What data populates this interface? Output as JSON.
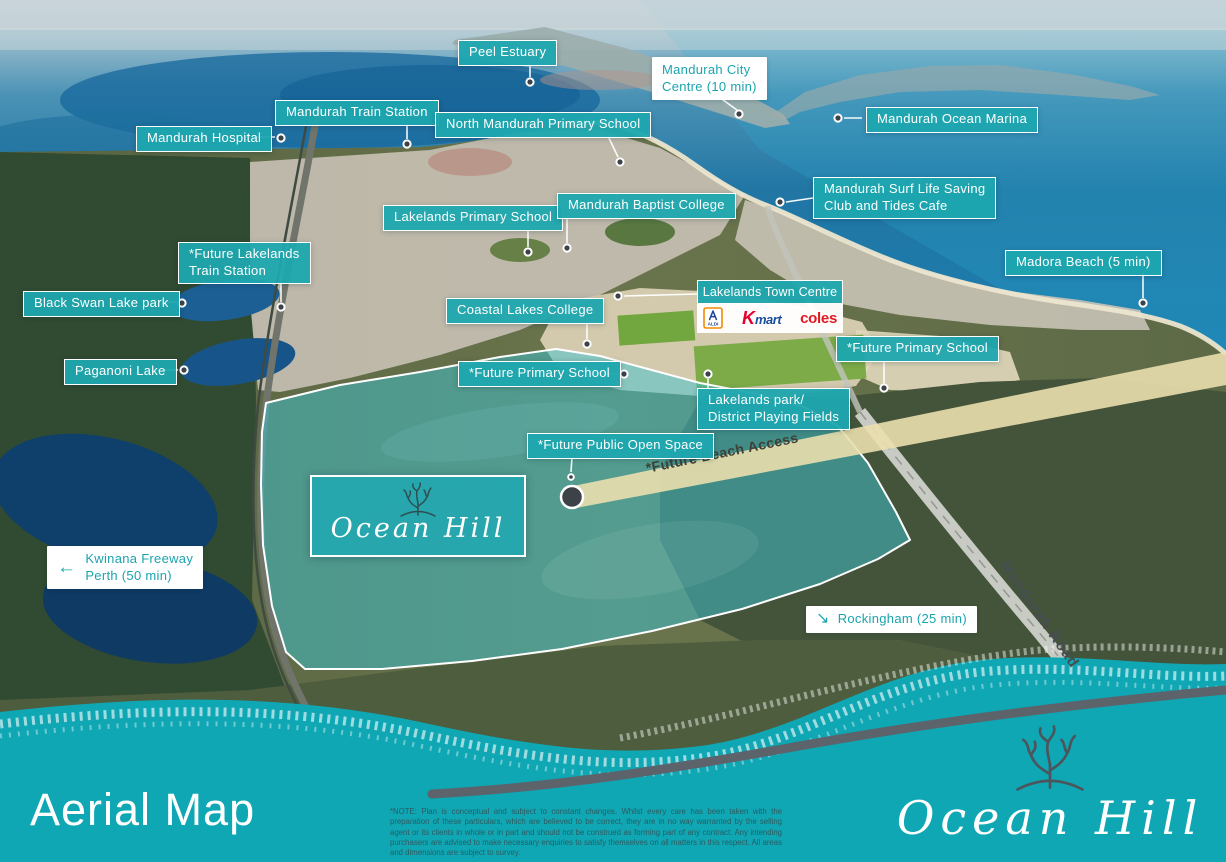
{
  "brand": {
    "script_text": "Ocean Hill"
  },
  "colors": {
    "label_teal": "#1ea6af",
    "accent_teal": "#1ba4ae",
    "band_teal": "#0fa7b4",
    "wave_gray": "#5c636b",
    "beach_band": "#eadfae",
    "dot_dark": "#3d4249",
    "kmart_red": "#e4002b",
    "kmart_blue": "#1c4f9e",
    "coles_red": "#e01a22",
    "aldi_blue": "#1b4297",
    "aldi_orange": "#f28b00"
  },
  "icons": {
    "arrow_left": "←",
    "arrow_southeast": "↘"
  },
  "map_labels": [
    {
      "id": "peel-estuary",
      "text": "Peel Estuary"
    },
    {
      "id": "mandurah-train-station",
      "text": "Mandurah Train Station"
    },
    {
      "id": "mandurah-hospital",
      "text": "Mandurah Hospital"
    },
    {
      "id": "north-mandurah-primary-school",
      "text": "North Mandurah Primary School"
    },
    {
      "id": "mandurah-ocean-marina",
      "text": "Mandurah Ocean Marina"
    },
    {
      "id": "mandurah-surf-life-saving-club",
      "line1": "Mandurah Surf Life Saving",
      "line2": "Club and Tides Cafe"
    },
    {
      "id": "lakelands-primary-school",
      "text": "Lakelands Primary School"
    },
    {
      "id": "mandurah-baptist-college",
      "text": "Mandurah Baptist College"
    },
    {
      "id": "future-lakelands-train-station",
      "line1": "*Future Lakelands",
      "line2": "Train Station"
    },
    {
      "id": "madora-beach",
      "text": "Madora Beach (5 min)"
    },
    {
      "id": "black-swan-lake-park",
      "text": "Black Swan Lake park"
    },
    {
      "id": "lakelands-town-centre",
      "text": "Lakelands Town Centre"
    },
    {
      "id": "coastal-lakes-college",
      "text": "Coastal Lakes College"
    },
    {
      "id": "future-primary-school-east",
      "text": "*Future Primary School"
    },
    {
      "id": "paganoni-lake",
      "text": "Paganoni Lake"
    },
    {
      "id": "future-primary-school-central",
      "text": "*Future Primary School"
    },
    {
      "id": "lakelands-park",
      "line1": "Lakelands park/",
      "line2": "District Playing Fields"
    },
    {
      "id": "future-public-open-space",
      "text": "*Future Public Open Space"
    }
  ],
  "white_labels": {
    "mandurah_city_centre": {
      "line1": "Mandurah City",
      "line2": "Centre (10 min)"
    },
    "kwinana_freeway": {
      "line1": "Kwinana Freeway",
      "line2": "Perth  (50 min)"
    },
    "rockingham": {
      "text": "Rockingham (25 min)"
    }
  },
  "map_texts": {
    "future_beach_access": "*Future Beach Access",
    "mandurah_road": "Mandurah Road"
  },
  "town_centre_logos": {
    "aldi": "ALDI",
    "kmart_k": "K",
    "kmart_rest": "mart",
    "coles": "coles"
  },
  "footer": {
    "title": "Aerial Map",
    "note": "*NOTE: Plan is conceptual and subject to constant changes. Whilst every care has been taken with the preparation of these particulars, which are believed to be correct, they are in no way warranted by the selling agent or its clients in whole or in part and should not be construed as forming part of any contract. Any intending purchasers are advised to make necessary enquiries to satisfy themselves on all matters in this respect. All areas and dimensions are subject to survey."
  }
}
